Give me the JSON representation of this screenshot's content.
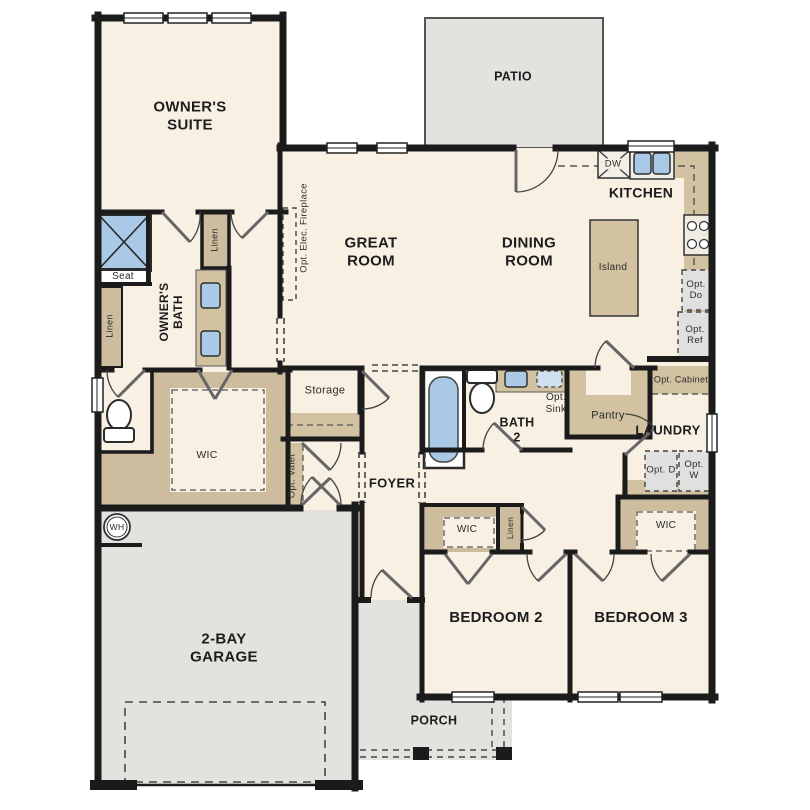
{
  "plan_title": "single-story floor plan",
  "labels": {
    "owners_suite": "OWNER'S SUITE",
    "patio": "PATIO",
    "great_room": "GREAT ROOM",
    "dining_room": "DINING ROOM",
    "kitchen": "KITCHEN",
    "island": "Island",
    "opt_elec_fireplace": "Opt. Elec. Fireplace",
    "seat": "Seat",
    "linen_bath_entry": "Linen",
    "linen_bath_wall": "Linen",
    "owners_bath": "OWNER'S BATH",
    "wic_owners": "WIC",
    "storage": "Storage",
    "opt_valet": "Opt. Valet",
    "foyer": "FOYER",
    "bath_2": "BATH 2",
    "opt_sink": "Opt. Sink",
    "pantry": "Pantry",
    "opt_cabinet": "Opt. Cabinet",
    "laundry": "LAUNDRY",
    "opt_d": "Opt. D",
    "opt_w": "Opt. W",
    "opt_do": "Opt. Do",
    "opt_ref": "Opt. Ref",
    "dw": "DW",
    "wh": "WH",
    "garage": "2-BAY GARAGE",
    "porch": "PORCH",
    "bedroom_2": "BEDROOM 2",
    "bedroom_3": "BEDROOM 3",
    "wic_bedroom2": "WIC",
    "linen_hall": "Linen",
    "wic_bedroom3": "WIC"
  },
  "colors": {
    "wall": "#1b1b1b",
    "room_fill": "#f8f1e3",
    "outdoor_fill": "#e3e2de",
    "cabinet_tan": "#d2c2a2",
    "closet_tan": "#cdbd9e",
    "fixture_blue": "#a9c9e6",
    "optional_gray": "#e0e0e0"
  }
}
